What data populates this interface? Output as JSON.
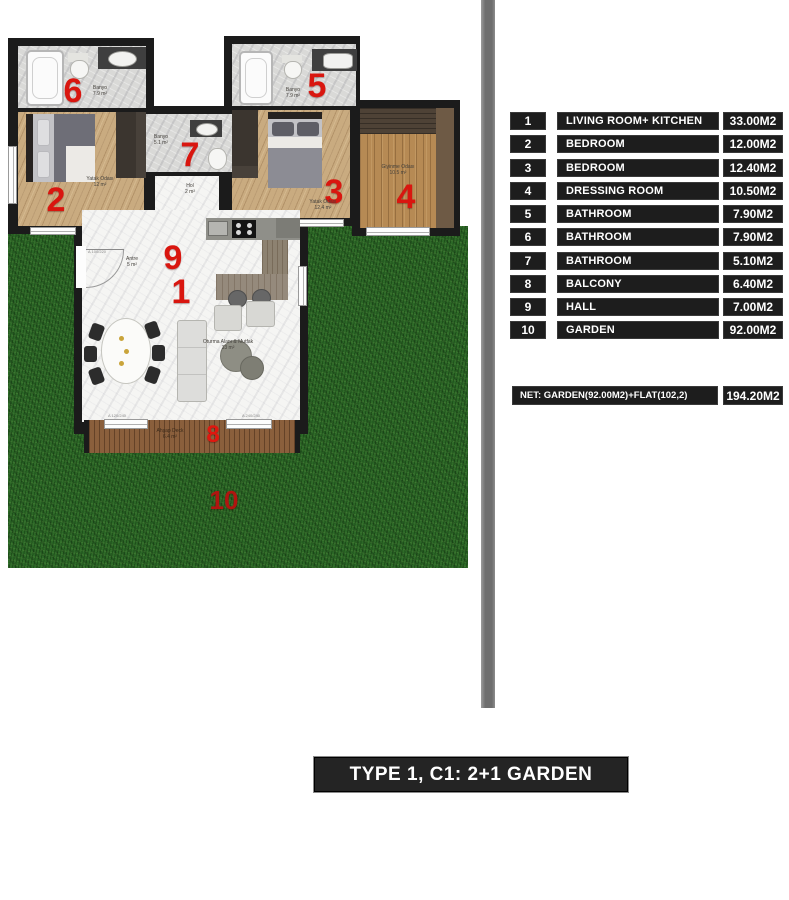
{
  "colors": {
    "accent_red": "#d9160f",
    "wall_black": "#1b1b1b",
    "grass_green": "#2c6827",
    "deck_brown": "#8a5f3c",
    "wood_floor": "#c9ab80",
    "marble": "#f5f5f3",
    "legend_bg": "#1d1d1d",
    "divider_gray": "#7a7a7a"
  },
  "legend": {
    "rows": [
      {
        "num": "1",
        "name": "LIVING ROOM+ KITCHEN",
        "area": "33.00M2"
      },
      {
        "num": "2",
        "name": "BEDROOM",
        "area": "12.00M2"
      },
      {
        "num": "3",
        "name": "BEDROOM",
        "area": "12.40M2"
      },
      {
        "num": "4",
        "name": "DRESSING ROOM",
        "area": "10.50M2"
      },
      {
        "num": "5",
        "name": "BATHROOM",
        "area": "7.90M2"
      },
      {
        "num": "6",
        "name": "BATHROOM",
        "area": "7.90M2"
      },
      {
        "num": "7",
        "name": "BATHROOM",
        "area": "5.10M2"
      },
      {
        "num": "8",
        "name": "BALCONY",
        "area": "6.40M2"
      },
      {
        "num": "9",
        "name": "HALL",
        "area": "7.00M2"
      },
      {
        "num": "10",
        "name": "GARDEN",
        "area": "92.00M2"
      }
    ],
    "net": {
      "label": "NET: GARDEN(92.00M2)+FLAT(102,2)",
      "area": "194.20M2"
    }
  },
  "title": {
    "text": "TYPE 1, C1: 2+1 GARDEN"
  },
  "plan": {
    "rooms": [
      {
        "num": "1",
        "label": "Oturma Alanı & Mutfak",
        "area": "33 m²"
      },
      {
        "num": "2",
        "label": "Yatak Odası",
        "area": "12 m²"
      },
      {
        "num": "3",
        "label": "Yatak Odası",
        "area": "12.4 m²"
      },
      {
        "num": "4",
        "label": "Giyinme Odası",
        "area": "10.5 m²"
      },
      {
        "num": "5",
        "label": "Banyo",
        "area": "7.9 m²"
      },
      {
        "num": "6",
        "label": "Banyo",
        "area": "7.9 m²"
      },
      {
        "num": "7",
        "label": "Banyo",
        "area": "5.1 m²"
      },
      {
        "num": "8",
        "label": "Ahşap Deck",
        "area": "6.4 m²"
      },
      {
        "num": "9",
        "label": "Antre",
        "area": "5 m²"
      },
      {
        "num": "10",
        "label": "",
        "area": ""
      }
    ],
    "hall": {
      "label": "Hol",
      "area": "2 m²"
    },
    "dimension_labels": [
      "A 100/220",
      "A 120/240",
      "A 240/240"
    ]
  }
}
